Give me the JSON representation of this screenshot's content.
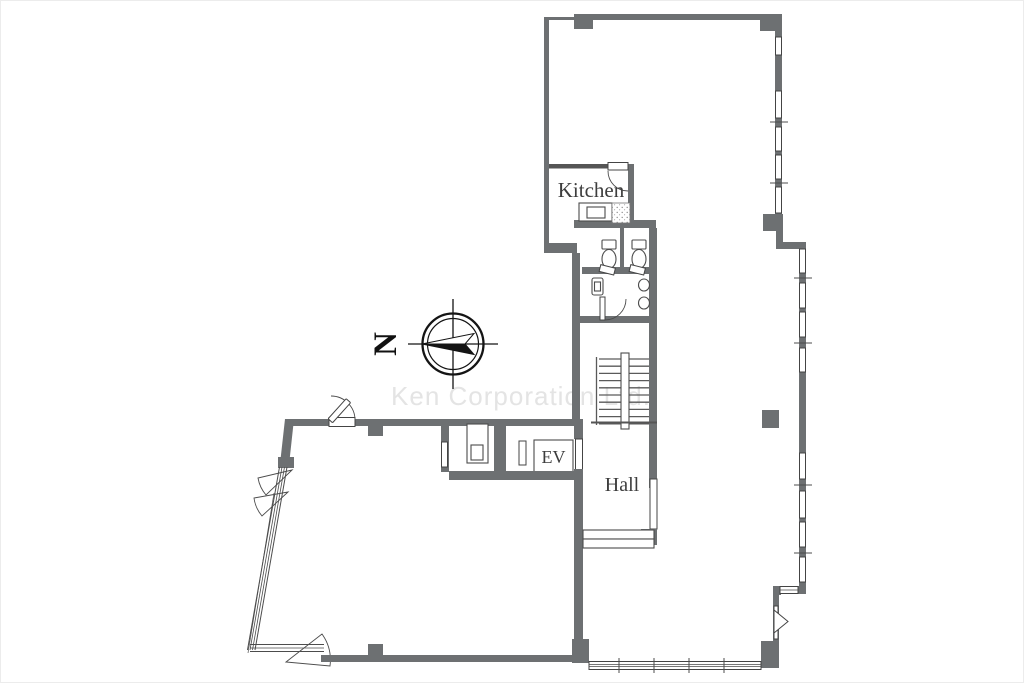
{
  "page": {
    "type": "floor-plan",
    "description": "Office building floor plan"
  },
  "labels": {
    "kitchen": "Kitchen",
    "elevator": "EV",
    "hall": "Hall"
  },
  "compass": {
    "north_letter": "N",
    "orientation": "north-points-left"
  },
  "watermark": {
    "text": "Ken Corporation Ltd."
  },
  "fixtures": [
    "kitchen-counter",
    "kitchen-tile",
    "toilet-stall",
    "toilet-stall",
    "washroom-sink",
    "wall-urinal",
    "wall-urinal",
    "staircase",
    "elevator-shaft",
    "pipe-shaft",
    "entry-step"
  ],
  "colors": {
    "wall": "#6d7072",
    "line": "#4c4c4c",
    "label_text": "#3d3d3d",
    "watermark": "#e4e4e4",
    "background": "#ffffff"
  }
}
